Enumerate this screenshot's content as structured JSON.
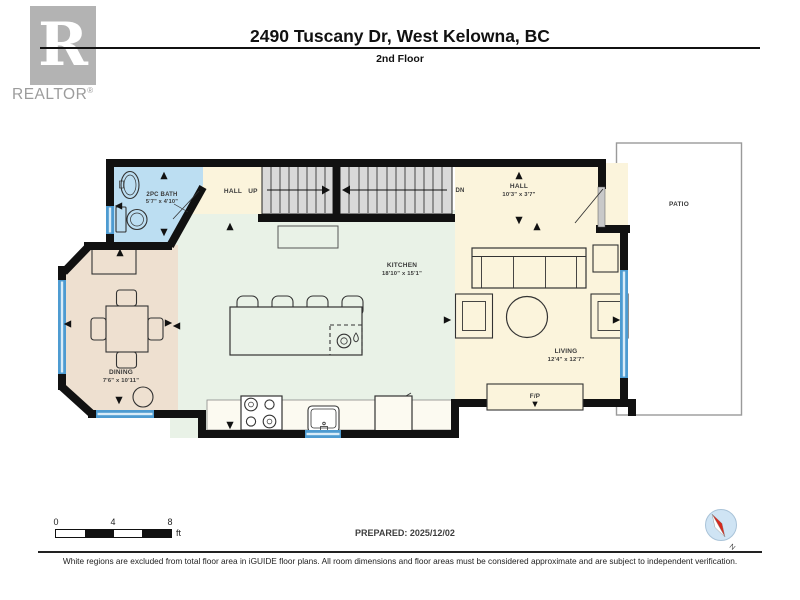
{
  "header": {
    "logo": {
      "letter": "R",
      "brand": "REALTOR",
      "reg": "®"
    },
    "title": "2490 Tuscany Dr, West Kelowna, BC",
    "subtitle": "2nd Floor"
  },
  "floorplan": {
    "rooms": {
      "bath": {
        "name": "2PC BATH",
        "dims": "5'7\" x 4'10\""
      },
      "hall_up": {
        "name": "HALL"
      },
      "hall": {
        "name": "HALL",
        "dims": "10'3\" x 3'7\""
      },
      "kitchen": {
        "name": "KITCHEN",
        "dims": "18'10\" x 15'1\""
      },
      "dining": {
        "name": "DINING",
        "dims": "7'6\" x 10'11\""
      },
      "living": {
        "name": "LIVING",
        "dims": "12'4\" x 12'7\""
      },
      "patio": {
        "name": "PATIO"
      }
    },
    "stairs": {
      "up": "UP",
      "down": "DN"
    },
    "fireplace": "F/P"
  },
  "scalebar": {
    "ticks": [
      "0",
      "4",
      "8"
    ],
    "unit": "ft"
  },
  "prepared": "PREPARED: 2025/12/02",
  "compass": {
    "label": "N"
  },
  "footer": "White regions are excluded from total floor area in iGUIDE floor plans. All room dimensions and floor areas must be considered approximate and are subject to independent verification.",
  "colors": {
    "wall": "#111111",
    "window": "#4d9bd1",
    "bath_floor": "#bcdef2",
    "kitchen_floor": "#e9f2e7",
    "dining_floor": "#eee0d0",
    "living_floor": "#fbf4dc",
    "stair_fill": "#d9d9d9",
    "patio_border": "#9a9a9a",
    "logo_gray": "#b3b3b3",
    "compass_red": "#d62a1e",
    "compass_blue": "#cfe4f4"
  }
}
